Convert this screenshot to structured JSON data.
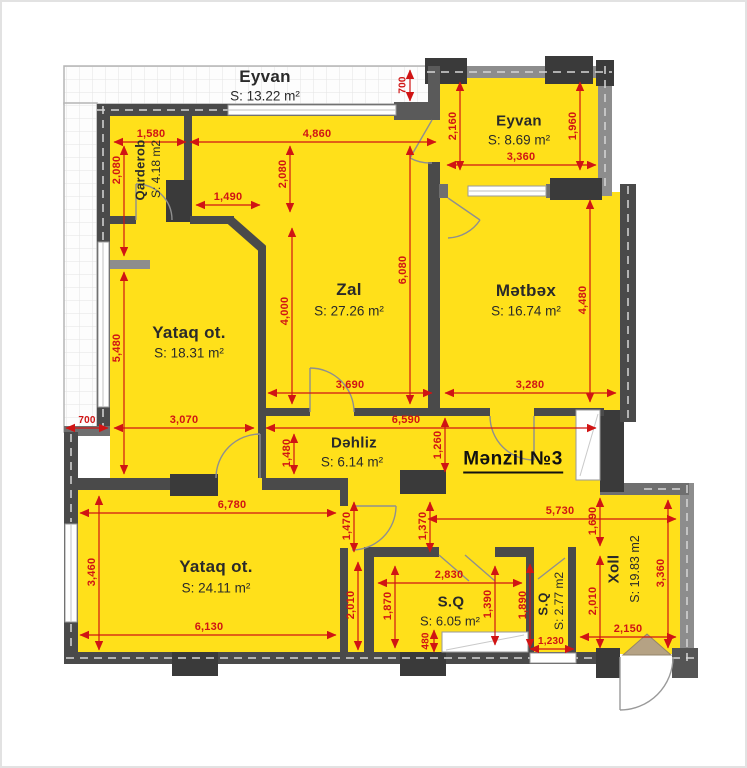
{
  "unit_label": "Mənzil №3",
  "rooms": [
    {
      "name": "Eyvan",
      "area": "S: 13.22 m²"
    },
    {
      "name": "Eyvan",
      "area": "S: 8.69 m²"
    },
    {
      "name": "Qarderob",
      "area": "S: 4.18 m2"
    },
    {
      "name": "Yataq ot.",
      "area": "S: 18.31 m²"
    },
    {
      "name": "Zal",
      "area": "S: 27.26 m²"
    },
    {
      "name": "Mətbəx",
      "area": "S: 16.74 m²"
    },
    {
      "name": "Dəhliz",
      "area": "S: 6.14 m²"
    },
    {
      "name": "Yataq ot.",
      "area": "S: 24.11 m²"
    },
    {
      "name": "S.Q",
      "area": "S: 6.05 m²"
    },
    {
      "name": "S.Q",
      "area": "S: 2.77 m2"
    },
    {
      "name": "Xoll",
      "area": "S: 19.83 m2"
    }
  ],
  "dims": [
    "700",
    "1,580",
    "4,860",
    "2,160",
    "1,960",
    "3,360",
    "2,080",
    "2,080",
    "1,490",
    "6,080",
    "4,480",
    "4,000",
    "5,480",
    "3,690",
    "3,280",
    "700",
    "3,070",
    "6,590",
    "1,480",
    "1,260",
    "6,780",
    "1,470",
    "1,370",
    "5,730",
    "1,690",
    "3,460",
    "2,830",
    "1,390",
    "1,890",
    "1,870",
    "2,010",
    "2,010",
    "3,360",
    "6,130",
    "480",
    "1,230",
    "2,150"
  ],
  "colors": {
    "room_fill": "#ffe01a",
    "dimension_red": "#d01414",
    "wall_dark": "#4a4a4a",
    "wall_light": "#8d8d8d",
    "column_dark": "#3a3a3a",
    "entrance_arrow_tan": "#b5a284"
  }
}
